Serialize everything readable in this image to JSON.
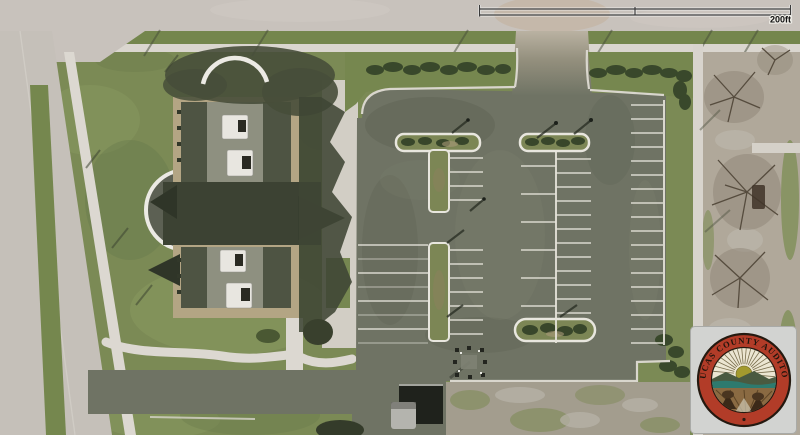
{
  "map": {
    "view_type": "aerial-imagery",
    "description": "Aerial photo of a civic building with circular drive, large striped parking lot with landscaped islands, bordering road with sidewalks, bare trees to the east",
    "scale_bar": {
      "label": "200ft"
    },
    "watermark": {
      "ring_text": "LUCAS COUNTY AUDITOR"
    },
    "features": {
      "building": "two-wing building with dark gable roofs and rooftop HVAC units",
      "parking": "three striped parking fields with curbed landscape islands",
      "roads": "road along west edge, road along top edge, access drive at south",
      "vehicle": "truck with trailer parked at south drive"
    },
    "palette": {
      "grass": "#7b8a55",
      "asphalt": "#6f7364",
      "road": "#c7c1bb",
      "sidewalk": "#dad6cf",
      "roof_dark": "#3c4233",
      "roof_side": "#4e5443",
      "roof_light": "#8e9080",
      "building_tan": "#b3a584",
      "hedge": "#39482b",
      "stripe": "#e6e4da",
      "seal_red": "#b23c28",
      "seal_cream": "#ece6d2",
      "seal_teal": "#2e7a6e",
      "seal_field_brown": "#8a6a42"
    }
  },
  "parking": {
    "stripe_color": "#e6e4da",
    "rows": [
      {
        "x1": 358,
        "x2": 428,
        "y_start": 245,
        "dy": 14,
        "count": 8,
        "alt_faint": true
      },
      {
        "x1": 449,
        "x2": 483,
        "y_start": 158,
        "dy": 14,
        "count": 4
      },
      {
        "x1": 449,
        "x2": 483,
        "y_start": 250,
        "dy": 14,
        "count": 7
      },
      {
        "x1": 521,
        "x2": 556,
        "y_start": 166,
        "dy": 28,
        "count": 6
      },
      {
        "x1": 556,
        "x2": 591,
        "y_start": 159,
        "dy": 14,
        "count": 12
      },
      {
        "x1": 631,
        "x2": 663,
        "y_start": 105,
        "dy": 14,
        "count": 18
      }
    ],
    "spines": [
      {
        "x": 556,
        "y1": 152,
        "y2": 343
      },
      {
        "x": 664,
        "y1": 100,
        "y2": 345
      }
    ]
  }
}
